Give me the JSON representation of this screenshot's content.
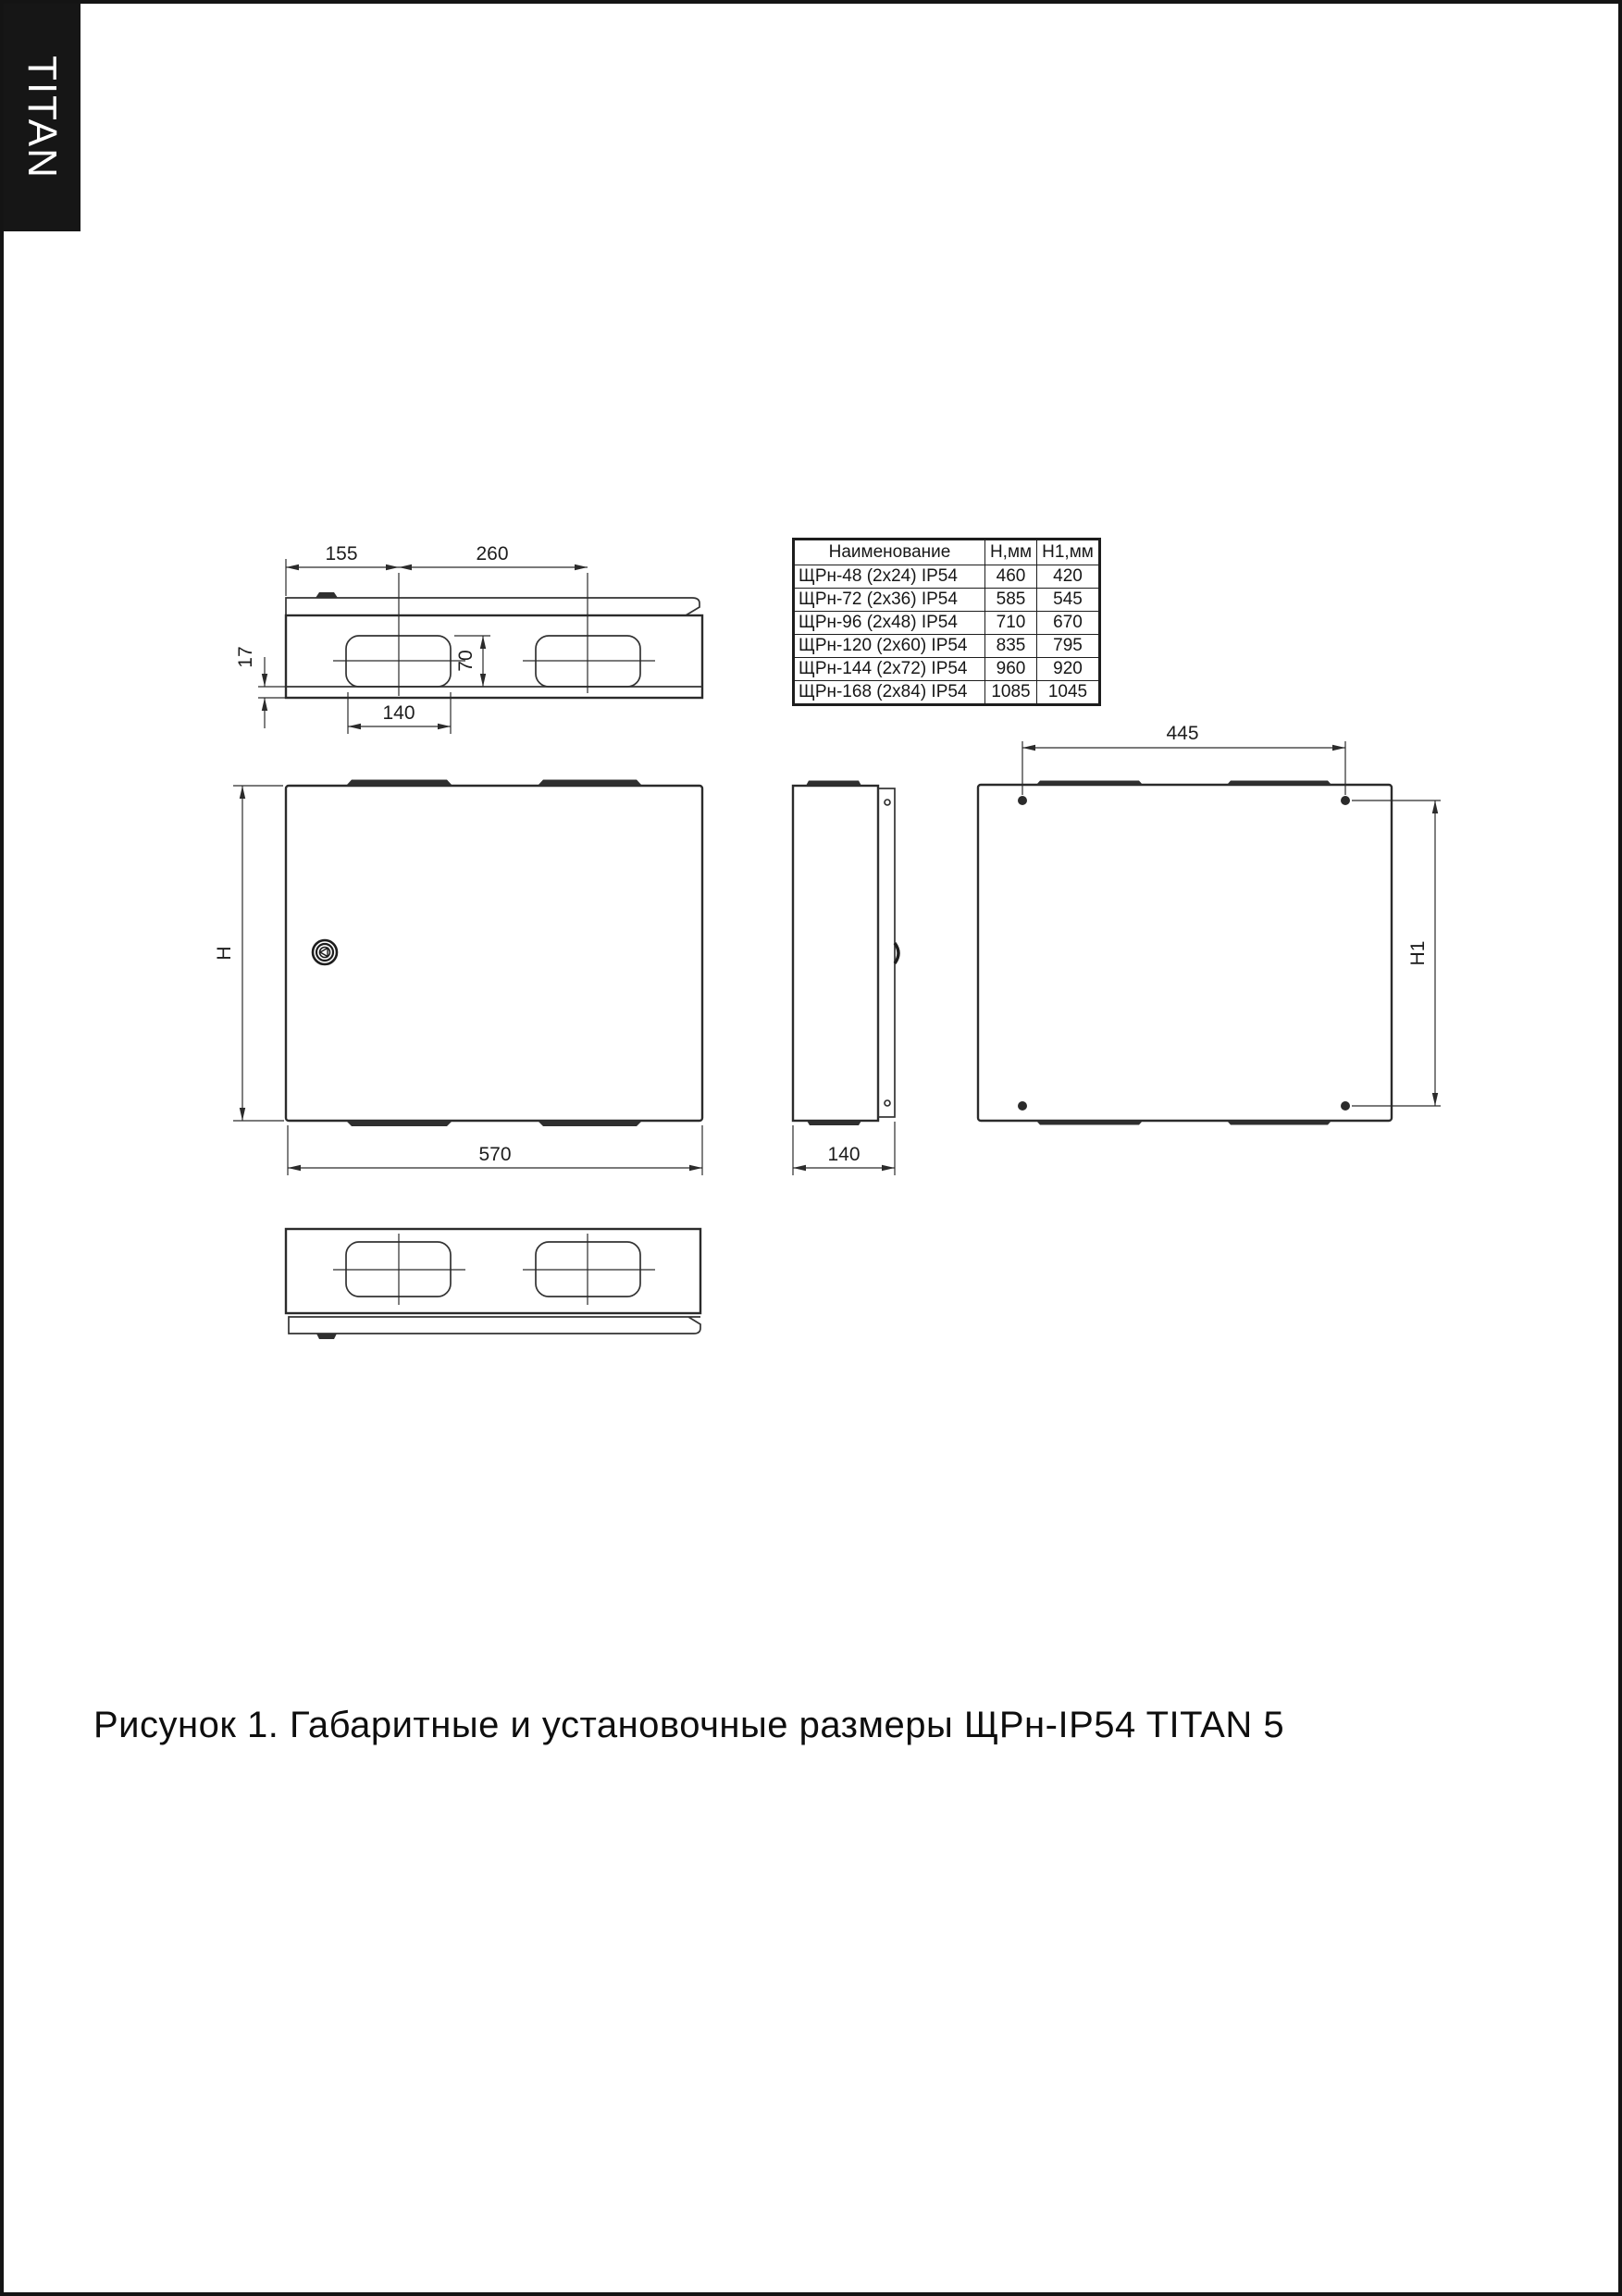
{
  "brand": {
    "label": "TITAN"
  },
  "figure": {
    "caption": "Рисунок 1. Габаритные и установочные размеры ЩРн-IP54 TITAN 5"
  },
  "table": {
    "headers": [
      "Наименование",
      "Н,мм",
      "Н1,мм"
    ],
    "rows": [
      [
        "ЩРн-48 (2х24) IP54",
        "460",
        "420"
      ],
      [
        "ЩРн-72 (2х36) IP54",
        "585",
        "545"
      ],
      [
        "ЩРн-96 (2х48) IP54",
        "710",
        "670"
      ],
      [
        "ЩРн-120 (2х60) IP54",
        "835",
        "795"
      ],
      [
        "ЩРн-144 (2х72) IP54",
        "960",
        "920"
      ],
      [
        "ЩРн-168 (2х84) IP54",
        "1085",
        "1045"
      ]
    ]
  },
  "dims": {
    "top": {
      "left_offset": "155",
      "hole_spacing": "260",
      "cutout_height": "70",
      "flange_depth": "17",
      "cutout_width": "140"
    },
    "front": {
      "height": "H",
      "width": "570"
    },
    "side": {
      "depth": "140"
    },
    "rear": {
      "hole_spacing": "445",
      "hole_height": "H1"
    }
  },
  "colors": {
    "line": "#2b2b2b",
    "brand_bg": "#161616",
    "paper": "#ffffff"
  }
}
